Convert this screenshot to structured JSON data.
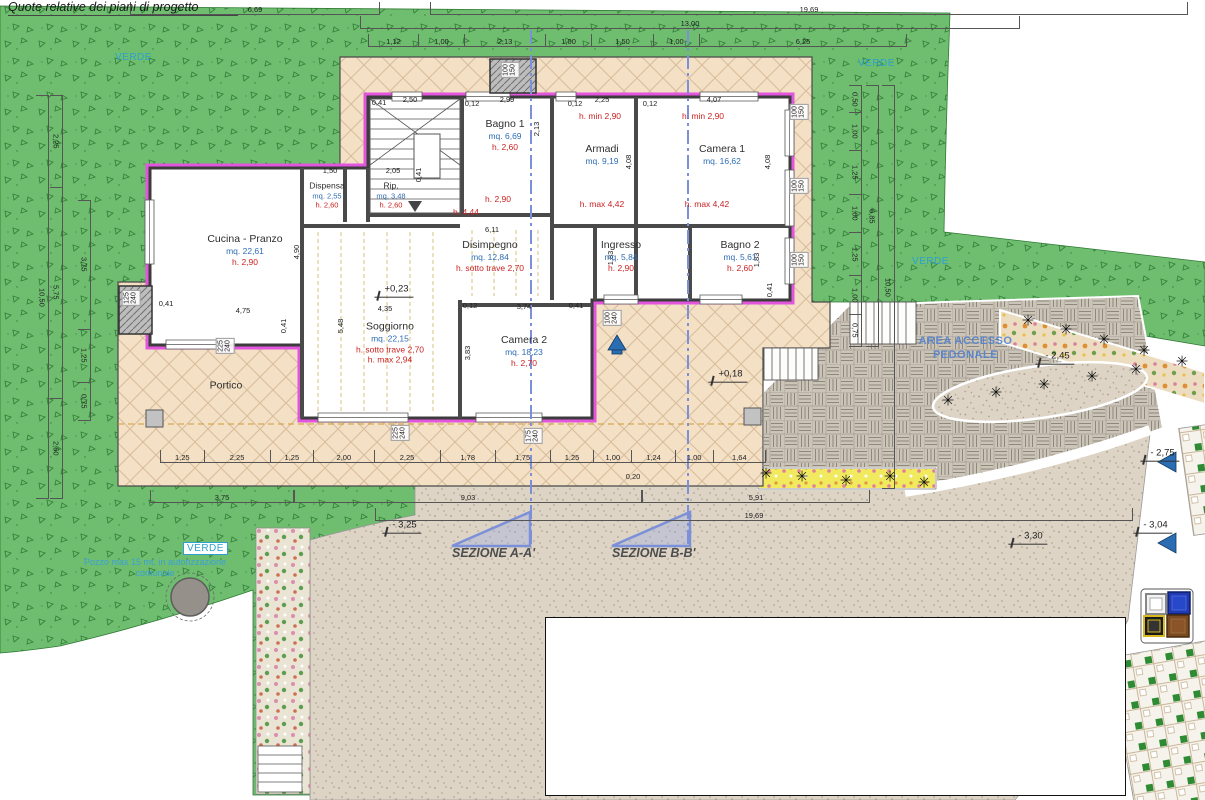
{
  "title": "Quote relative dei piani di progetto",
  "site_labels": {
    "verde": "VERDE",
    "pozzo": "Pozzo max 15 mt. in autorizzazione\ncomunale",
    "area_accesso": "AREA ACCESSO\nPEDONALE",
    "sezione_a": "SEZIONE A-A'",
    "sezione_b": "SEZIONE B-B'"
  },
  "rooms": [
    {
      "name": "Cucina - Pranzo",
      "area": "mq. 22,61",
      "height": "h. 2,90"
    },
    {
      "name": "Dispensa",
      "area": "mq. 2,55",
      "height": "h. 2,60"
    },
    {
      "name": "Rip.",
      "area": "mq. 3,48",
      "height": "h. 2,60"
    },
    {
      "name": "Bagno 1",
      "area": "mq. 6,69",
      "height": "h. 2,60"
    },
    {
      "name": "Armadi",
      "area": "mq. 9,19"
    },
    {
      "name": "Camera 1",
      "area": "mq. 16,62"
    },
    {
      "name": "Disimpegno",
      "area": "mq. 12,84",
      "height": "h. sotto trave 2,70"
    },
    {
      "name": "Ingresso",
      "area": "mq. 5,84",
      "height": "h. 2,90"
    },
    {
      "name": "Bagno 2",
      "area": "mq. 5,61",
      "height": "h. 2,60"
    },
    {
      "name": "Soggiorno",
      "area": "mq. 22,15",
      "height": "h. sotto trave 2,70",
      "extra": "h. max 2,94"
    },
    {
      "name": "Camera 2",
      "area": "mq. 18,23",
      "height": "h. 2,70"
    },
    {
      "name": "Portico"
    }
  ],
  "dims": {
    "top1": [
      "6,69"
    ],
    "top2": [
      "19,69"
    ],
    "top3": [
      "13,00"
    ],
    "top4": [
      "1,12",
      "1,00",
      "2,13",
      "1,00",
      "1,50",
      "1,00",
      "6,25"
    ],
    "bottom": [
      "1,25",
      "2,25",
      "1,25",
      "2,00",
      "2,25",
      "1,78",
      "1,75",
      "1,25",
      "1,00",
      "1,24",
      "1,00",
      "1,64"
    ],
    "bottom_green": [
      "3,75"
    ],
    "bottom_mid": [
      "9,03"
    ],
    "bottom_right": [
      "5,91"
    ],
    "bottom_total": [
      "19,69"
    ],
    "left_outer": [
      "10,50"
    ],
    "left_mid": [
      "2,25",
      "5,75",
      "2,50"
    ],
    "left_inner": [
      "3,75",
      "1,25",
      "0,75"
    ],
    "right_inner": [
      "0,50",
      "1,00",
      "1,25",
      "1,00",
      "1,25",
      "1,00",
      "0,75"
    ],
    "right_mid": [
      "6,85"
    ],
    "right_outer": [
      "10,50"
    ]
  },
  "scatter": {
    "inline_dims": [
      {
        "t": "0,41",
        "x": 379,
        "y": 103
      },
      {
        "t": "2,50",
        "x": 410,
        "y": 100
      },
      {
        "t": "0,12",
        "x": 472,
        "y": 104
      },
      {
        "t": "2,99",
        "x": 507,
        "y": 100
      },
      {
        "t": "0,12",
        "x": 575,
        "y": 104
      },
      {
        "t": "2,25",
        "x": 602,
        "y": 100
      },
      {
        "t": "0,12",
        "x": 650,
        "y": 104
      },
      {
        "t": "4,07",
        "x": 714,
        "y": 100
      },
      {
        "t": "2,13",
        "x": 537,
        "y": 129,
        "r": -90
      },
      {
        "t": "4,08",
        "x": 629,
        "y": 162,
        "r": -90
      },
      {
        "t": "4,08",
        "x": 768,
        "y": 162,
        "r": -90
      },
      {
        "t": "1,50",
        "x": 330,
        "y": 171
      },
      {
        "t": "2,05",
        "x": 393,
        "y": 171
      },
      {
        "t": "6,11",
        "x": 492,
        "y": 230
      },
      {
        "t": "4,90",
        "x": 297,
        "y": 252,
        "r": -90
      },
      {
        "t": "0,41",
        "x": 419,
        "y": 175,
        "r": -90
      },
      {
        "t": "1,83",
        "x": 611,
        "y": 258,
        "r": -90
      },
      {
        "t": "1,83",
        "x": 757,
        "y": 260,
        "r": -90
      },
      {
        "t": "0,41",
        "x": 770,
        "y": 290,
        "r": -90
      },
      {
        "t": "0,41",
        "x": 166,
        "y": 304
      },
      {
        "t": "4,75",
        "x": 243,
        "y": 311
      },
      {
        "t": "0,41",
        "x": 284,
        "y": 326,
        "r": -90
      },
      {
        "t": "4,35",
        "x": 385,
        "y": 309
      },
      {
        "t": "0,12",
        "x": 470,
        "y": 306
      },
      {
        "t": "3,74",
        "x": 524,
        "y": 307
      },
      {
        "t": "0,41",
        "x": 576,
        "y": 306
      },
      {
        "t": "5,48",
        "x": 341,
        "y": 326,
        "r": -90
      },
      {
        "t": "3,83",
        "x": 468,
        "y": 353,
        "r": -90
      },
      {
        "t": "0,20",
        "x": 633,
        "y": 477
      }
    ],
    "red_labels": [
      {
        "t": "h. min 2,90",
        "x": 600,
        "y": 117
      },
      {
        "t": "h. min 2,90",
        "x": 703,
        "y": 117
      },
      {
        "t": "h. max 4,42",
        "x": 602,
        "y": 205
      },
      {
        "t": "h. max 4,42",
        "x": 707,
        "y": 205
      },
      {
        "t": "h. 2,90",
        "x": 498,
        "y": 200
      },
      {
        "t": "h. 4,44",
        "x": 466,
        "y": 213
      }
    ],
    "levels": [
      {
        "t": "+0,23",
        "x": 394,
        "y": 291
      },
      {
        "t": "+0,18",
        "x": 728,
        "y": 376
      },
      {
        "t": "- 2,45",
        "x": 1055,
        "y": 358
      },
      {
        "t": "- 2,75",
        "x": 1160,
        "y": 455
      },
      {
        "t": "- 3,04",
        "x": 1153,
        "y": 527
      },
      {
        "t": "- 3,25",
        "x": 402,
        "y": 527
      },
      {
        "t": "- 3,30",
        "x": 1028,
        "y": 538
      }
    ],
    "window_tags": [
      {
        "t": "100\n150",
        "x": 510,
        "y": 70,
        "r": -90
      },
      {
        "t": "100\n150",
        "x": 799,
        "y": 112,
        "r": -90
      },
      {
        "t": "100\n150",
        "x": 799,
        "y": 186,
        "r": -90
      },
      {
        "t": "100\n150",
        "x": 799,
        "y": 260,
        "r": -90
      },
      {
        "t": "100\n240",
        "x": 612,
        "y": 318,
        "r": -90
      },
      {
        "t": "125\n240",
        "x": 131,
        "y": 298,
        "r": -90
      },
      {
        "t": "225\n240",
        "x": 225,
        "y": 346,
        "r": -90
      },
      {
        "t": "225\n240",
        "x": 400,
        "y": 433,
        "r": -90
      },
      {
        "t": "175\n240",
        "x": 533,
        "y": 436,
        "r": -90
      }
    ],
    "palms": [
      {
        "t": "✳",
        "x": 1028,
        "y": 322
      },
      {
        "t": "✳",
        "x": 1066,
        "y": 331
      },
      {
        "t": "✳",
        "x": 1104,
        "y": 341
      },
      {
        "t": "✳",
        "x": 1144,
        "y": 352
      },
      {
        "t": "✳",
        "x": 1182,
        "y": 363
      },
      {
        "t": "✳",
        "x": 948,
        "y": 402
      },
      {
        "t": "✳",
        "x": 996,
        "y": 394
      },
      {
        "t": "✳",
        "x": 1044,
        "y": 386
      },
      {
        "t": "✳",
        "x": 1092,
        "y": 378
      },
      {
        "t": "✳",
        "x": 1136,
        "y": 371
      },
      {
        "t": "✳",
        "x": 766,
        "y": 475
      },
      {
        "t": "✳",
        "x": 802,
        "y": 478
      },
      {
        "t": "✳",
        "x": 846,
        "y": 482
      },
      {
        "t": "✳",
        "x": 890,
        "y": 478
      },
      {
        "t": "✳",
        "x": 924,
        "y": 484
      }
    ]
  },
  "icons": {
    "palm": "✳"
  },
  "colors": {
    "grass": "#6fbe70",
    "slab": "#f3e0c5",
    "gravel": "#ddd4c6",
    "paving": "#cbc4b8",
    "wall_insulation": "#e256dd",
    "section_line": "#7b90d8",
    "area_text": "#2e6db4",
    "height_text": "#cc2222",
    "verde_text": "#2da0d0",
    "area_accesso_text": "#4a7fd4"
  }
}
